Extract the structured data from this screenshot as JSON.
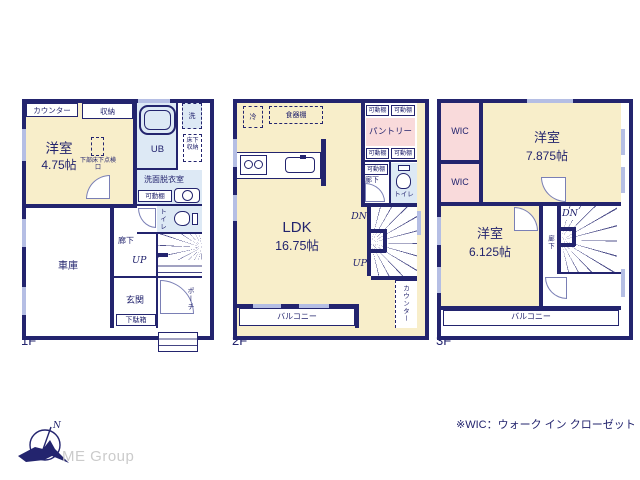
{
  "colors": {
    "wall": "#23246e",
    "cream": "#f8eeca",
    "pink": "#f9dadb",
    "light_blue": "#dde9f5",
    "window": "#b5bee4",
    "logo_gray": "#cbcbcb"
  },
  "f1": {
    "label": "1F",
    "counter": "カウンター",
    "storage": "収納",
    "room": "洋室",
    "room_size": "4.75帖",
    "hatch": "下部床下点検口",
    "ub": "UB",
    "wash": "洗",
    "underfloor": "床下収納",
    "sanitary": "洗面脱衣室",
    "shelf": "可動棚",
    "toilet": "トイレ",
    "garage": "車庫",
    "hall": "廊下",
    "up": "UP",
    "entrance": "玄関",
    "shoebox": "下駄箱",
    "porch": "ポーチ"
  },
  "f2": {
    "label": "2F",
    "fridge": "冷",
    "cupboard": "食器棚",
    "shelf": "可動棚",
    "pantry": "パントリー",
    "hall": "廊下",
    "toilet": "トイレ",
    "ldk": "LDK",
    "ldk_size": "16.75帖",
    "dn": "DN",
    "up": "UP",
    "counter": "カウンター",
    "balcony": "バルコニー"
  },
  "f3": {
    "label": "3F",
    "wic": "WIC",
    "room1": "洋室",
    "room1_size": "7.875帖",
    "room2": "洋室",
    "room2_size": "6.125帖",
    "dn": "DN",
    "hall": "廊下",
    "balcony": "バルコニー"
  },
  "footer": {
    "note": "※WIC：ウォーク イン クローゼット",
    "brand": "ME Group",
    "north": "N"
  }
}
